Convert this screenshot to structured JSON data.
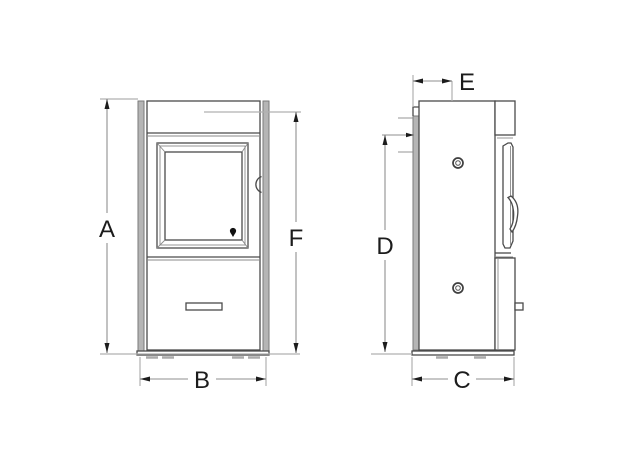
{
  "drawing": {
    "labels": {
      "A": "A",
      "B": "B",
      "C": "C",
      "D": "D",
      "E": "E",
      "F": "F"
    },
    "front_view_dimensions": [
      "A",
      "B",
      "F"
    ],
    "side_view_dimensions": [
      "E",
      "D",
      "C"
    ],
    "colors": {
      "background": "#ffffff",
      "outline": "#4a4a4a",
      "secondary_line": "#8a8a8a",
      "dimension_line": "#8f8f8f",
      "extension_line": "#b0b0b0",
      "panel_fill": "#b5b5b5",
      "arrow_and_text": "#1c1c1c"
    }
  }
}
